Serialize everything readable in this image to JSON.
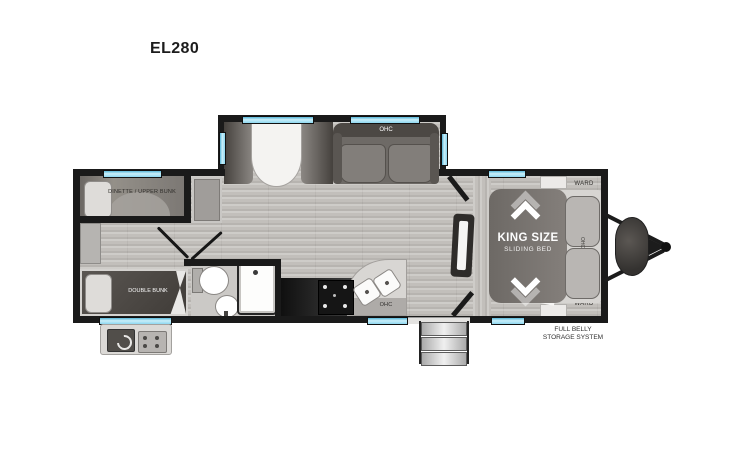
{
  "title": "EL280",
  "plan": {
    "bunk_room_label": "DINETTE / UPPER BUNK",
    "double_bunk_label": "DOUBLE BUNK",
    "sofa_ohc_label": "OHC",
    "kitchen_ohc_label": "OHC",
    "bed_ohc_label": "OHC",
    "bed_title": "KING SIZE",
    "bed_subtitle": "SLIDING BED",
    "ward_top_label": "WARD",
    "ward_bottom_label": "WARD",
    "storage_line1": "FULL BELLY",
    "storage_line2": "STORAGE SYSTEM"
  },
  "colors": {
    "wall": "#1a1a1a",
    "window_glass": "#8ed7f0",
    "floor": "#c2bfbb",
    "dark_furniture": "#55504c",
    "bed_slide": "#797571",
    "counter_dark": "#141414",
    "fixture_white": "#ffffff",
    "label_dark": "#312f2c"
  }
}
